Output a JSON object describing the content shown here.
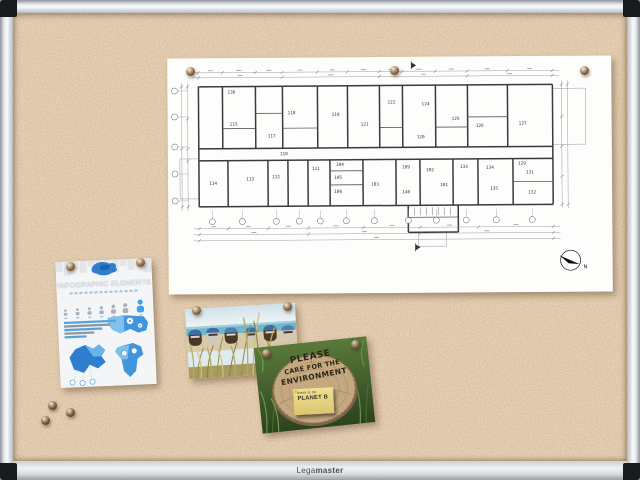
{
  "board": {
    "brand_light": "Lega",
    "brand_bold": "master",
    "cork_base": "#d3a878",
    "frame_color": "#e9edef"
  },
  "floor_plan": {
    "north_label": "N",
    "walls": [
      [
        31,
        28,
        385,
        28
      ],
      [
        385,
        28,
        385,
        148
      ],
      [
        385,
        148,
        31,
        148
      ],
      [
        31,
        148,
        31,
        28
      ],
      [
        31,
        90,
        385,
        90
      ],
      [
        31,
        102,
        385,
        102
      ],
      [
        55,
        28,
        55,
        90
      ],
      [
        88,
        28,
        88,
        90
      ],
      [
        115,
        28,
        115,
        90
      ],
      [
        150,
        28,
        150,
        90
      ],
      [
        180,
        28,
        180,
        90
      ],
      [
        212,
        28,
        212,
        90
      ],
      [
        235,
        28,
        235,
        90
      ],
      [
        268,
        28,
        268,
        90
      ],
      [
        300,
        28,
        300,
        90
      ],
      [
        340,
        28,
        340,
        90
      ],
      [
        60,
        102,
        60,
        148
      ],
      [
        100,
        102,
        100,
        148
      ],
      [
        120,
        102,
        120,
        148
      ],
      [
        140,
        102,
        140,
        148
      ],
      [
        162,
        102,
        162,
        148
      ],
      [
        195,
        102,
        195,
        148
      ],
      [
        228,
        102,
        228,
        148
      ],
      [
        252,
        102,
        252,
        148
      ],
      [
        285,
        102,
        285,
        148
      ],
      [
        310,
        102,
        310,
        148
      ],
      [
        345,
        102,
        345,
        148
      ],
      [
        240,
        148,
        240,
        175
      ],
      [
        240,
        175,
        290,
        175
      ],
      [
        290,
        175,
        290,
        148
      ]
    ],
    "inner_walls": [
      [
        55,
        70,
        88,
        70
      ],
      [
        115,
        70,
        150,
        70
      ],
      [
        212,
        70,
        235,
        70
      ],
      [
        268,
        70,
        300,
        70
      ],
      [
        88,
        55,
        115,
        55
      ],
      [
        300,
        60,
        340,
        60
      ],
      [
        162,
        113,
        195,
        113
      ],
      [
        162,
        127,
        195,
        127
      ],
      [
        345,
        125,
        385,
        125
      ],
      [
        240,
        160,
        290,
        160
      ]
    ],
    "thin_rects": [
      [
        385,
        32,
        33,
        56
      ],
      [
        12,
        100,
        19,
        40
      ],
      [
        250,
        175,
        28,
        14
      ]
    ],
    "stairs_x": [
      246,
      252,
      258,
      264,
      270,
      276,
      282
    ],
    "stairs_y1": 150,
    "stairs_y2": 158,
    "labels": [
      {
        "t": "136",
        "x": 64,
        "y": 35
      },
      {
        "t": "115",
        "x": 66,
        "y": 67
      },
      {
        "t": "117",
        "x": 104,
        "y": 79
      },
      {
        "t": "118",
        "x": 124,
        "y": 56
      },
      {
        "t": "119",
        "x": 168,
        "y": 58
      },
      {
        "t": "121",
        "x": 197,
        "y": 68
      },
      {
        "t": "122",
        "x": 224,
        "y": 46
      },
      {
        "t": "124",
        "x": 258,
        "y": 48
      },
      {
        "t": "120",
        "x": 253,
        "y": 81
      },
      {
        "t": "125",
        "x": 288,
        "y": 63
      },
      {
        "t": "126",
        "x": 312,
        "y": 70
      },
      {
        "t": "127",
        "x": 355,
        "y": 68
      },
      {
        "t": "110",
        "x": 116,
        "y": 97
      },
      {
        "t": "114",
        "x": 45,
        "y": 126
      },
      {
        "t": "113",
        "x": 82,
        "y": 122
      },
      {
        "t": "112",
        "x": 108,
        "y": 120
      },
      {
        "t": "111",
        "x": 148,
        "y": 112
      },
      {
        "t": "104",
        "x": 172,
        "y": 108
      },
      {
        "t": "105",
        "x": 170,
        "y": 121
      },
      {
        "t": "106",
        "x": 170,
        "y": 135
      },
      {
        "t": "103",
        "x": 207,
        "y": 128
      },
      {
        "t": "109",
        "x": 238,
        "y": 111
      },
      {
        "t": "140",
        "x": 238,
        "y": 136
      },
      {
        "t": "102",
        "x": 262,
        "y": 114
      },
      {
        "t": "101",
        "x": 276,
        "y": 129
      },
      {
        "t": "133",
        "x": 296,
        "y": 111
      },
      {
        "t": "134",
        "x": 322,
        "y": 112
      },
      {
        "t": "135",
        "x": 326,
        "y": 133
      },
      {
        "t": "129",
        "x": 354,
        "y": 108
      },
      {
        "t": "131",
        "x": 362,
        "y": 117
      },
      {
        "t": "132",
        "x": 364,
        "y": 137
      }
    ],
    "h_dims": [
      {
        "y": 14,
        "ticks": [
          31,
          55,
          88,
          115,
          150,
          180,
          212,
          235,
          268,
          300,
          340,
          385
        ]
      },
      {
        "y": 19,
        "ticks": [
          31,
          115,
          212,
          300,
          385
        ]
      },
      {
        "y": 170,
        "ticks": [
          31,
          60,
          100,
          140,
          195,
          252,
          310,
          385
        ]
      },
      {
        "y": 176,
        "ticks": [
          31,
          140,
          252,
          385
        ]
      },
      {
        "y": 182,
        "ticks": [
          31,
          385
        ]
      }
    ],
    "v_dims": [
      {
        "x": 20,
        "ticks": [
          28,
          60,
          90,
          102,
          148
        ]
      },
      {
        "x": 14,
        "ticks": [
          28,
          90,
          148
        ]
      },
      {
        "x": 394,
        "ticks": [
          28,
          60,
          90,
          120,
          148
        ]
      },
      {
        "x": 400,
        "ticks": [
          28,
          148
        ]
      }
    ],
    "grid_left": {
      "x": 7,
      "ys": [
        32,
        58,
        88,
        115,
        142
      ]
    },
    "grid_bottom": {
      "y": 163,
      "xs": [
        44,
        74,
        108,
        131,
        152,
        178,
        206,
        240,
        268,
        298,
        328,
        364
      ]
    },
    "north": {
      "cx": 402,
      "cy": 204,
      "r": 10
    },
    "section_markers": [
      [
        244,
        4,
        244,
        12
      ],
      [
        247,
        186,
        247,
        194
      ]
    ]
  },
  "infographic": {
    "title": "INFOGRAPHIC ELEMENTS",
    "figures": [
      6.5,
      7,
      7.5,
      8,
      9,
      10,
      13
    ],
    "figure_color": "#a9b2ba",
    "figure_highlight": "#42a0e8",
    "bars": [
      52,
      46,
      38,
      30,
      22
    ],
    "bar_colors": [
      "#57a3d9",
      "#8e98a2",
      "#57a3d9",
      "#8e98a2",
      "#57a3d9"
    ]
  },
  "environment_poster": {
    "line1": "PLEASE",
    "line2": "CARE FOR THE",
    "line3": "ENVIRONMENT",
    "note_line1": "there is no",
    "note_line2": "PLANET B"
  },
  "pins": {
    "groups": [
      {
        "name": "floor-plan-pins",
        "color": "#8a6a49",
        "points": [
          [
            190,
            71
          ],
          [
            394,
            70
          ],
          [
            584,
            70
          ]
        ]
      },
      {
        "name": "infographic-pins",
        "color": "#8a6a49",
        "points": [
          [
            70,
            266
          ],
          [
            140,
            262
          ]
        ]
      },
      {
        "name": "beach-pins",
        "color": "#8a6a49",
        "points": [
          [
            196,
            310
          ],
          [
            287,
            306
          ]
        ]
      },
      {
        "name": "environment-pins",
        "color": "#7c6246",
        "points": [
          [
            266,
            353
          ],
          [
            355,
            344
          ]
        ]
      },
      {
        "name": "loose-pins",
        "color": "#6d5a42",
        "points": [
          [
            52,
            405
          ],
          [
            45,
            420
          ],
          [
            70,
            412
          ]
        ]
      }
    ]
  }
}
